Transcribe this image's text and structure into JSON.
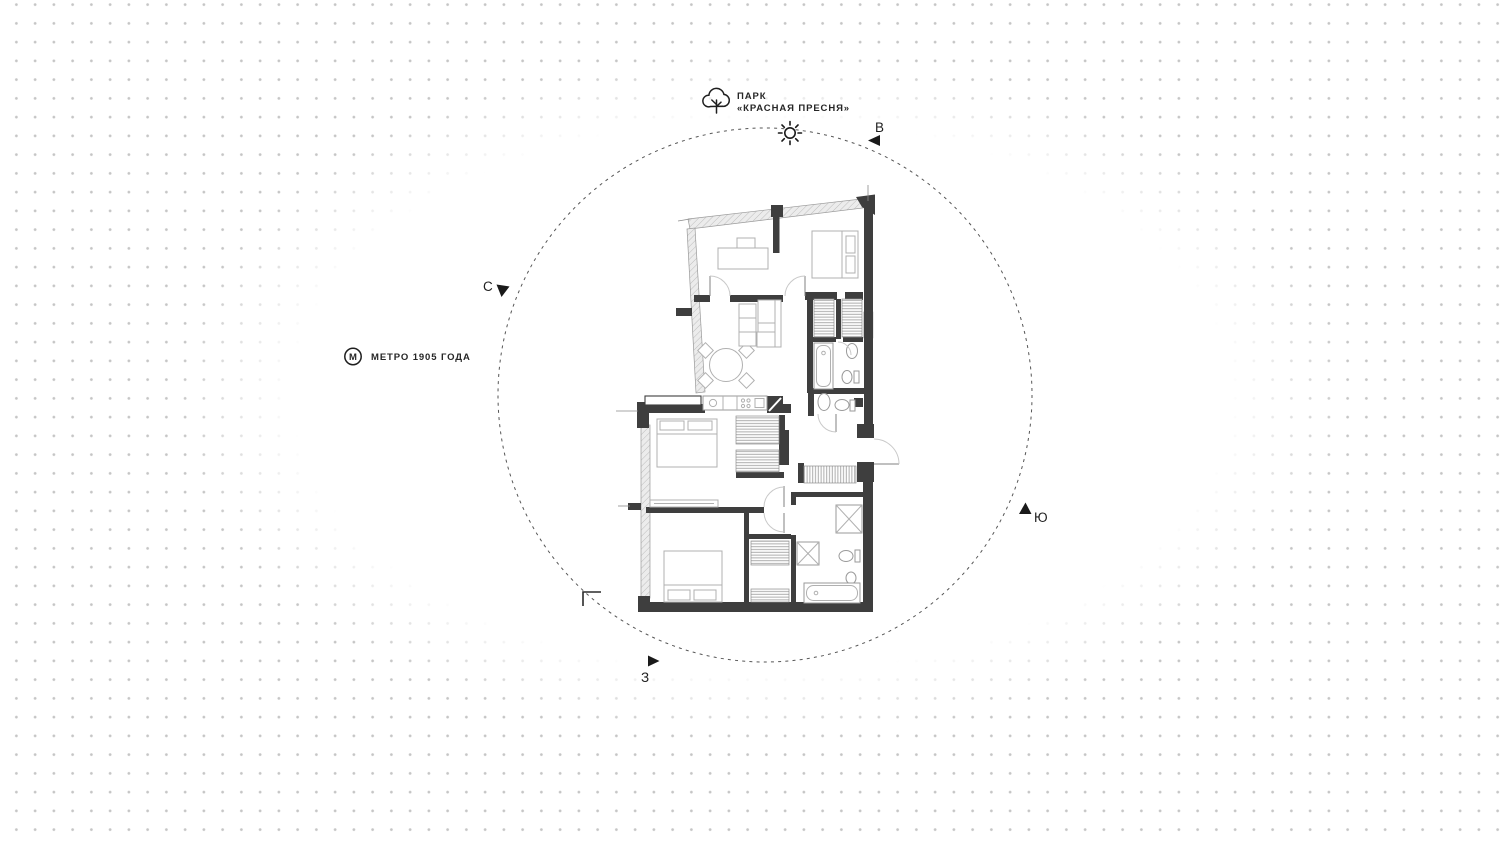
{
  "canvas": {
    "width_px": 1500,
    "height_px": 842
  },
  "background": {
    "style": "dot-grid",
    "dot_color": "#c5c5c5",
    "dot_spacing_px": 18.75,
    "center_fade": "white ellipse centered on plan"
  },
  "landmarks": {
    "park": {
      "line1": "ПАРК",
      "line2": "«КРАСНАЯ ПРЕСНЯ»",
      "icon": "tree-icon"
    },
    "metro": {
      "label": "МЕТРО 1905 ГОДА",
      "icon": "metro-icon",
      "icon_letter": "М"
    }
  },
  "compass": {
    "north": "С",
    "east": "В",
    "south": "Ю",
    "west": "З",
    "sun_icon": "sun-icon",
    "circle_style": "dashed"
  },
  "floor_plan": {
    "type": "apartment-plan",
    "rooms": [
      "bedroom-top-left",
      "bedroom-top-right",
      "living-kitchen",
      "bedroom-middle",
      "bedroom-bottom",
      "bathroom-1",
      "bathroom-2",
      "bathroom-3",
      "hall",
      "wardrobes"
    ],
    "features": [
      "entrance-door-arc-right-wall",
      "window-walls-hatched",
      "corner-section-mark"
    ]
  },
  "colors": {
    "wall": "#3e3e3e",
    "text": "#262626",
    "furniture_line": "#b0b0b0",
    "hatch_line": "#bdbdbd",
    "dash_circle": "#565656",
    "dot": "#c5c5c5"
  }
}
